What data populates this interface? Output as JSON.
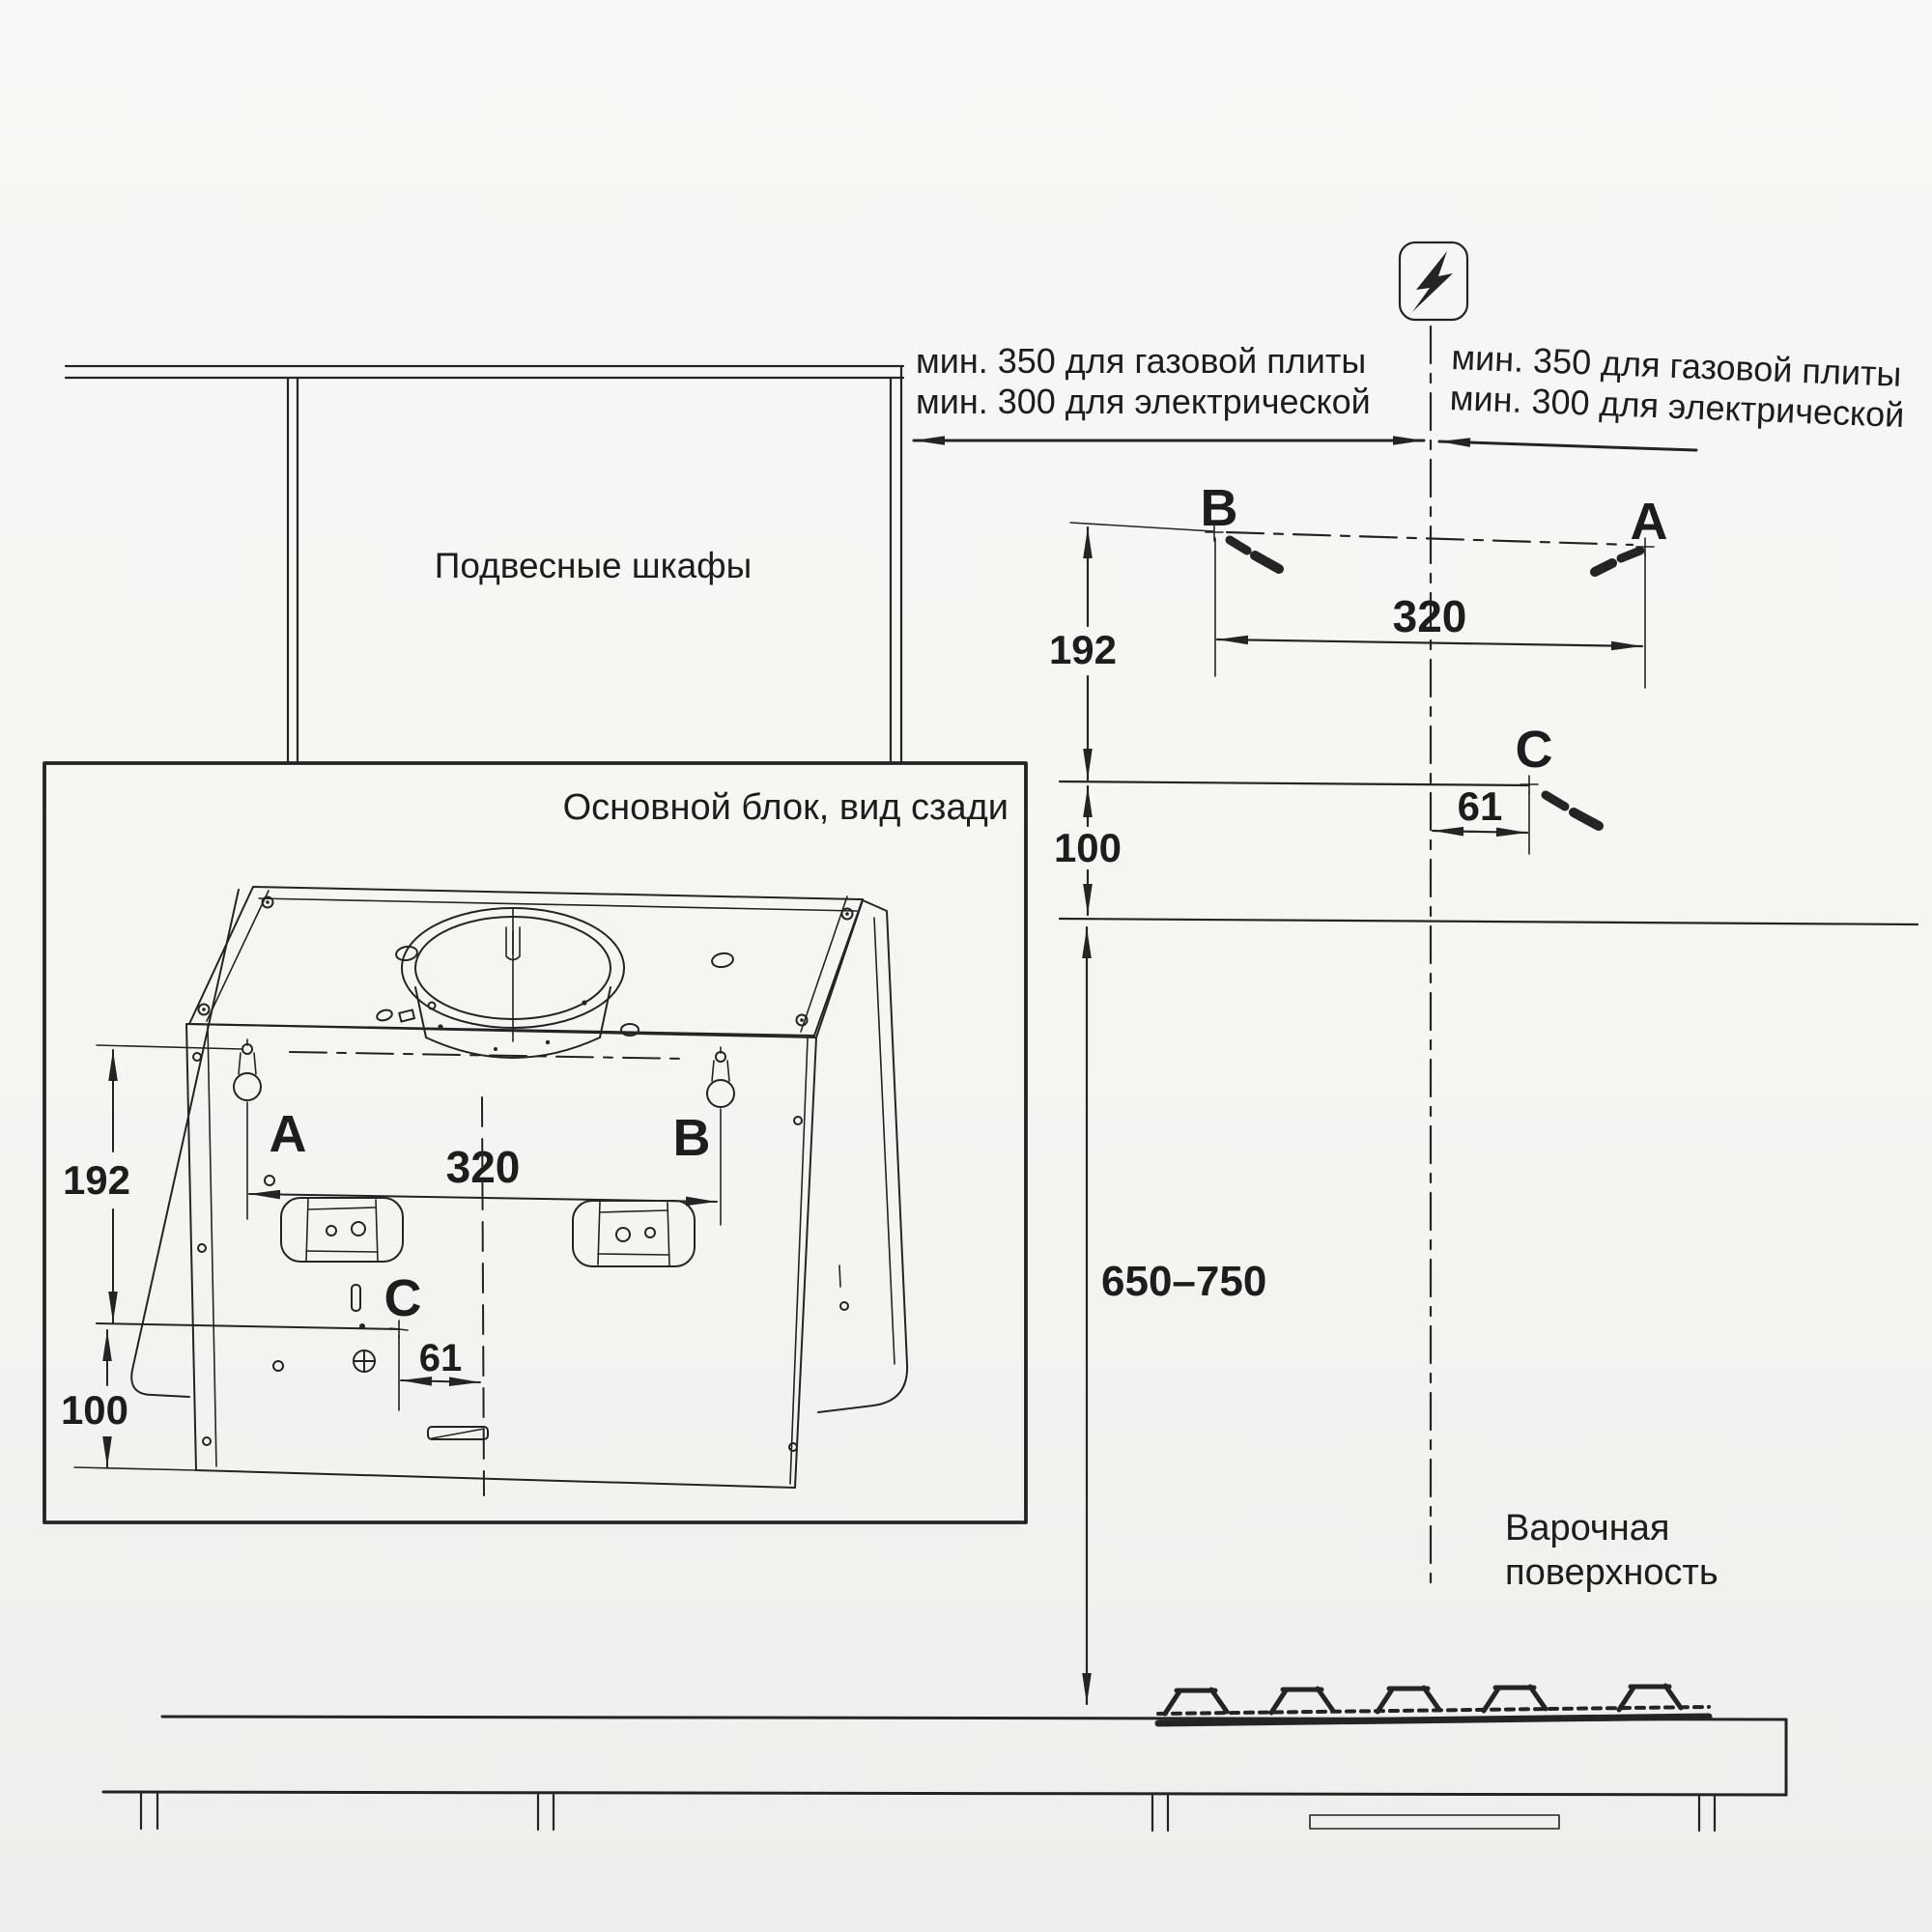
{
  "page": {
    "paper_color": "#f6f5f2",
    "ink_color": "#242424"
  },
  "labels": {
    "hanging_cabinets": "Подвесные шкафы",
    "main_unit_rear_view": "Основной блок, вид сзади",
    "hob_surface_line1": "Варочная",
    "hob_surface_line2": "поверхность"
  },
  "clearance_note": {
    "gas_line": "мин. 350 для газовой плиты",
    "electric_line": "мин. 300 для электрической"
  },
  "mount_points": {
    "a": "A",
    "b": "B",
    "c": "C"
  },
  "dimensions_mm": {
    "mount_hole_spacing": "320",
    "top_row_to_c": "192",
    "c_to_bottom": "100",
    "c_offset_from_centerline": "61",
    "hood_to_hob_range": "650–750"
  },
  "icons": {
    "power_symbol": "lightning-bolt"
  }
}
